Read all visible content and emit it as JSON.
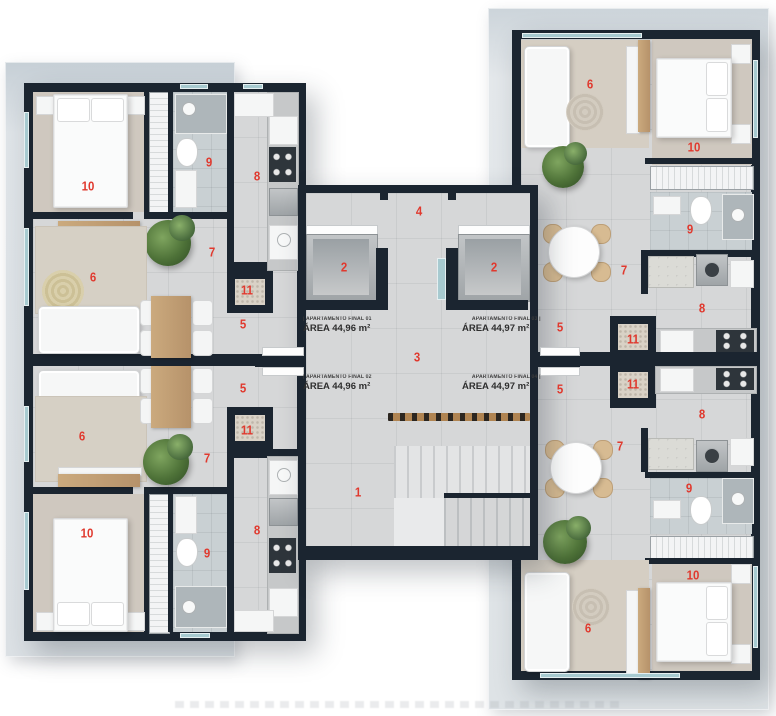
{
  "title": "Residential floor plan - 4 apartments per floor",
  "apartments": [
    {
      "id": "final-01",
      "name": "| APARTAMENTO FINAL 01",
      "area": "ÁREA 44,96 m²"
    },
    {
      "id": "final-02",
      "name": "| APARTAMENTO FINAL 02",
      "area": "ÁREA 44,96 m²"
    },
    {
      "id": "final-03",
      "name": "APARTAMENTO FINAL 03 |",
      "area": "ÁREA 44,97 m²"
    },
    {
      "id": "final-04",
      "name": "APARTAMENTO FINAL 04 |",
      "area": "ÁREA 44,97 m²"
    }
  ],
  "markers": [
    {
      "label": "10",
      "room": "bedroom",
      "apartment": "final-01"
    },
    {
      "label": "9",
      "room": "bathroom",
      "apartment": "final-01"
    },
    {
      "label": "8",
      "room": "kitchen",
      "apartment": "final-01"
    },
    {
      "label": "7",
      "room": "hallway",
      "apartment": "final-01"
    },
    {
      "label": "6",
      "room": "living",
      "apartment": "final-01"
    },
    {
      "label": "11",
      "room": "laundry",
      "apartment": "final-01"
    },
    {
      "label": "5",
      "room": "entry",
      "apartment": "final-01"
    },
    {
      "label": "5",
      "room": "entry",
      "apartment": "final-02"
    },
    {
      "label": "11",
      "room": "laundry",
      "apartment": "final-02"
    },
    {
      "label": "7",
      "room": "hallway",
      "apartment": "final-02"
    },
    {
      "label": "6",
      "room": "living",
      "apartment": "final-02"
    },
    {
      "label": "10",
      "room": "bedroom",
      "apartment": "final-02"
    },
    {
      "label": "9",
      "room": "bathroom",
      "apartment": "final-02"
    },
    {
      "label": "8",
      "room": "kitchen",
      "apartment": "final-02"
    },
    {
      "label": "6",
      "room": "living",
      "apartment": "final-03"
    },
    {
      "label": "10",
      "room": "bedroom",
      "apartment": "final-03"
    },
    {
      "label": "9",
      "room": "bathroom",
      "apartment": "final-03"
    },
    {
      "label": "7",
      "room": "hallway",
      "apartment": "final-03"
    },
    {
      "label": "8",
      "room": "kitchen",
      "apartment": "final-03"
    },
    {
      "label": "11",
      "room": "laundry",
      "apartment": "final-03"
    },
    {
      "label": "5",
      "room": "entry",
      "apartment": "final-03"
    },
    {
      "label": "5",
      "room": "entry",
      "apartment": "final-04"
    },
    {
      "label": "11",
      "room": "laundry",
      "apartment": "final-04"
    },
    {
      "label": "8",
      "room": "kitchen",
      "apartment": "final-04"
    },
    {
      "label": "7",
      "room": "hallway",
      "apartment": "final-04"
    },
    {
      "label": "9",
      "room": "bathroom",
      "apartment": "final-04"
    },
    {
      "label": "10",
      "room": "bedroom",
      "apartment": "final-04"
    },
    {
      "label": "6",
      "room": "living",
      "apartment": "final-04"
    },
    {
      "label": "2",
      "room": "elevator-left",
      "apartment": "common"
    },
    {
      "label": "2",
      "room": "elevator-right",
      "apartment": "common"
    },
    {
      "label": "4",
      "room": "corridor",
      "apartment": "common"
    },
    {
      "label": "3",
      "room": "hall",
      "apartment": "common"
    },
    {
      "label": "1",
      "room": "stair-landing",
      "apartment": "common"
    }
  ],
  "colors": {
    "wall": "#1b2530",
    "floor": "#d6d7d8",
    "bathroom_tile": "#c9d0d3",
    "bedroom_carpet": "#cfc8bf",
    "rug": "#d6d0c5",
    "wood": "#c8a97c",
    "plant": "#4e7238",
    "marker_red": "#e0392e",
    "glass": "#a7cad0",
    "slab": "#dde3e7",
    "furniture_white": "#f6f7f7",
    "label_text": "#2e2e2e"
  }
}
